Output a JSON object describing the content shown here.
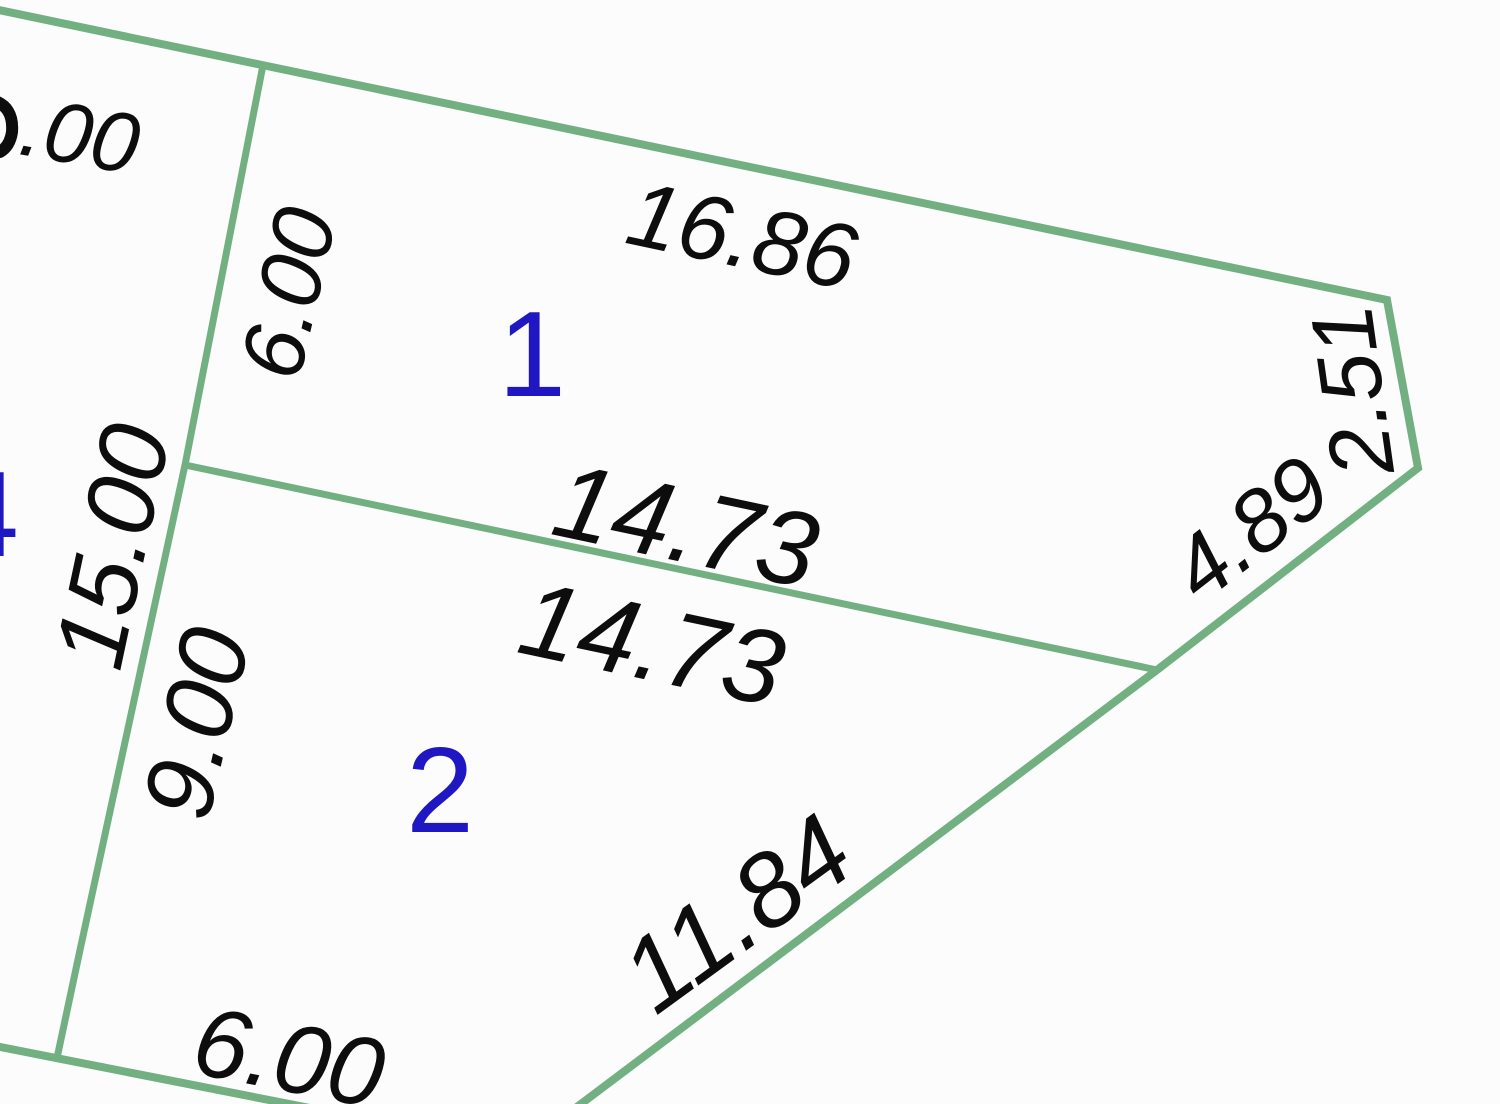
{
  "diagram": {
    "type": "cadastral-parcel-plan",
    "colors": {
      "boundary_green": "#72b082",
      "dimension_text": "#0d0d0d",
      "parcel_number_blue": "#1f17c2",
      "background": "#fcfcfc"
    },
    "parcels": [
      {
        "number": "1",
        "edge_dimensions": [
          "16.86",
          "6.00",
          "14.73",
          "2.51",
          "4.89"
        ]
      },
      {
        "number": "2",
        "edge_dimensions": [
          "14.73",
          "9.00",
          "11.84",
          "6.00"
        ]
      },
      {
        "number": "4",
        "edge_dimensions": [
          "15.00",
          ".00"
        ]
      }
    ]
  },
  "labels": {
    "top_left_partial": ".00",
    "p1_west": "6.00",
    "p1_north": "16.86",
    "p1_northeast": "2.51",
    "p1_east": "4.89",
    "divider_north": "14.73",
    "divider_south": "14.73",
    "p4_east": "15.00",
    "p2_west": "9.00",
    "p2_southeast": "11.84",
    "p2_south": "6.00",
    "parcel_1": "1",
    "parcel_2": "2",
    "parcel_4": "4"
  }
}
